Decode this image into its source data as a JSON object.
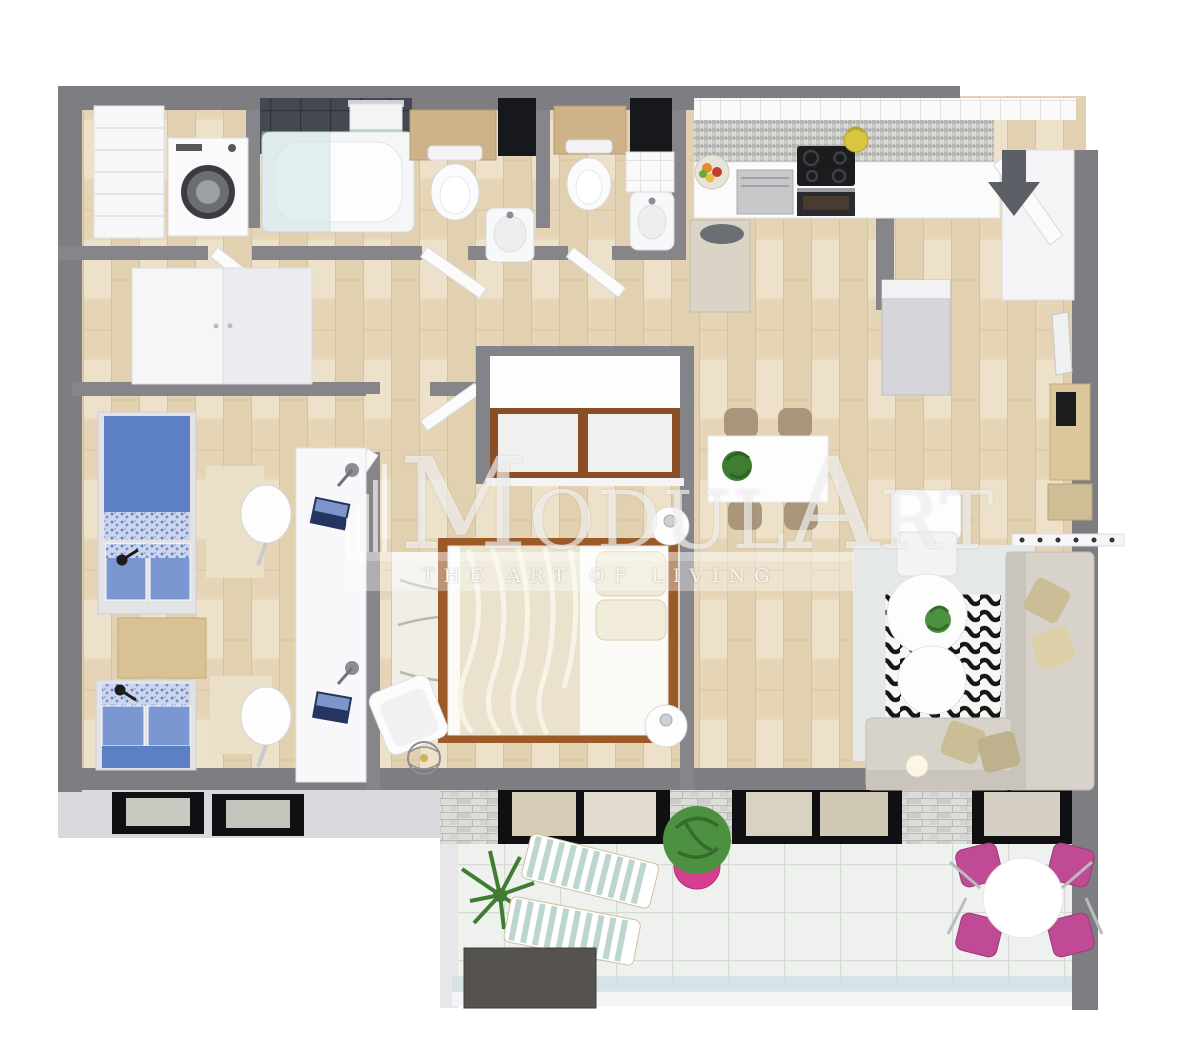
{
  "watermark": {
    "logo_m": "M",
    "logo_odul": "ODUL",
    "logo_a": "A",
    "logo_rt": "RT",
    "tagline": "THE ART OF LIVING"
  },
  "entrance": {
    "icon": "entrance-arrow-down"
  },
  "palette": {
    "wall_gray": "#7e7e82",
    "wall_face_light": "#d9d9dd",
    "floor_wood": "#e8d9bc",
    "balcony_tile": "#eff1ee",
    "brick_white": "#dcdcd9",
    "bedding_blue": "#5c80c3",
    "accent_pink": "#c04a94",
    "plant_green": "#4c9140",
    "sofa_gray": "#d7d3cb",
    "cushion_beige": "#d9c8a0",
    "wood_brown": "#9c5a28",
    "frame_black": "#111114",
    "glass_blue": "#cfe3e6"
  },
  "rooms": [
    {
      "id": "laundry",
      "furniture": [
        "shelving-unit",
        "washing-machine"
      ]
    },
    {
      "id": "bathroom",
      "furniture": [
        "dark-tile-wall",
        "towel-rail",
        "bathtub",
        "glass-screen",
        "toilet",
        "washbasin"
      ]
    },
    {
      "id": "wc",
      "furniture": [
        "toilet",
        "washbasin",
        "tiled-half-wall"
      ]
    },
    {
      "id": "kitchen",
      "furniture": [
        "wall-tiles",
        "mosaic-backsplash",
        "fruit-bowl",
        "dishwasher",
        "cooktop",
        "kettle",
        "oven",
        "tall-cabinet",
        "bar-table"
      ]
    },
    {
      "id": "entry-hall",
      "furniture": [
        "front-door",
        "entrance-arrow",
        "hall-cabinet",
        "mirror",
        "console-with-drawer",
        "shoe-shelf",
        "coat-rack"
      ]
    },
    {
      "id": "kids-bedroom",
      "furniture": [
        "wardrobe",
        "single-bed-1",
        "single-bed-2",
        "wood-nightstand",
        "reading-lamps",
        "double-desk",
        "desk-chairs",
        "laptops",
        "rugs"
      ]
    },
    {
      "id": "master-bedroom",
      "furniture": [
        "sliding-wardrobe-alcove",
        "double-bed",
        "duvet",
        "pillows",
        "wavy-rug",
        "round-nightstands",
        "armchair",
        "wire-floor-lamp"
      ]
    },
    {
      "id": "living-dining",
      "furniture": [
        "dining-table",
        "dining-chairs",
        "table-plant",
        "lounge-armchair",
        "corner-sofa",
        "cushions",
        "coffee-tables",
        "zebra-rug",
        "area-rug",
        "floor-lamp"
      ]
    },
    {
      "id": "balcony",
      "furniture": [
        "white-brick-wall",
        "sliding-glass-doors",
        "palm-plant",
        "sun-loungers",
        "pink-potted-plant",
        "storage-box",
        "round-table",
        "pink-chairs",
        "glass-railing"
      ]
    }
  ]
}
